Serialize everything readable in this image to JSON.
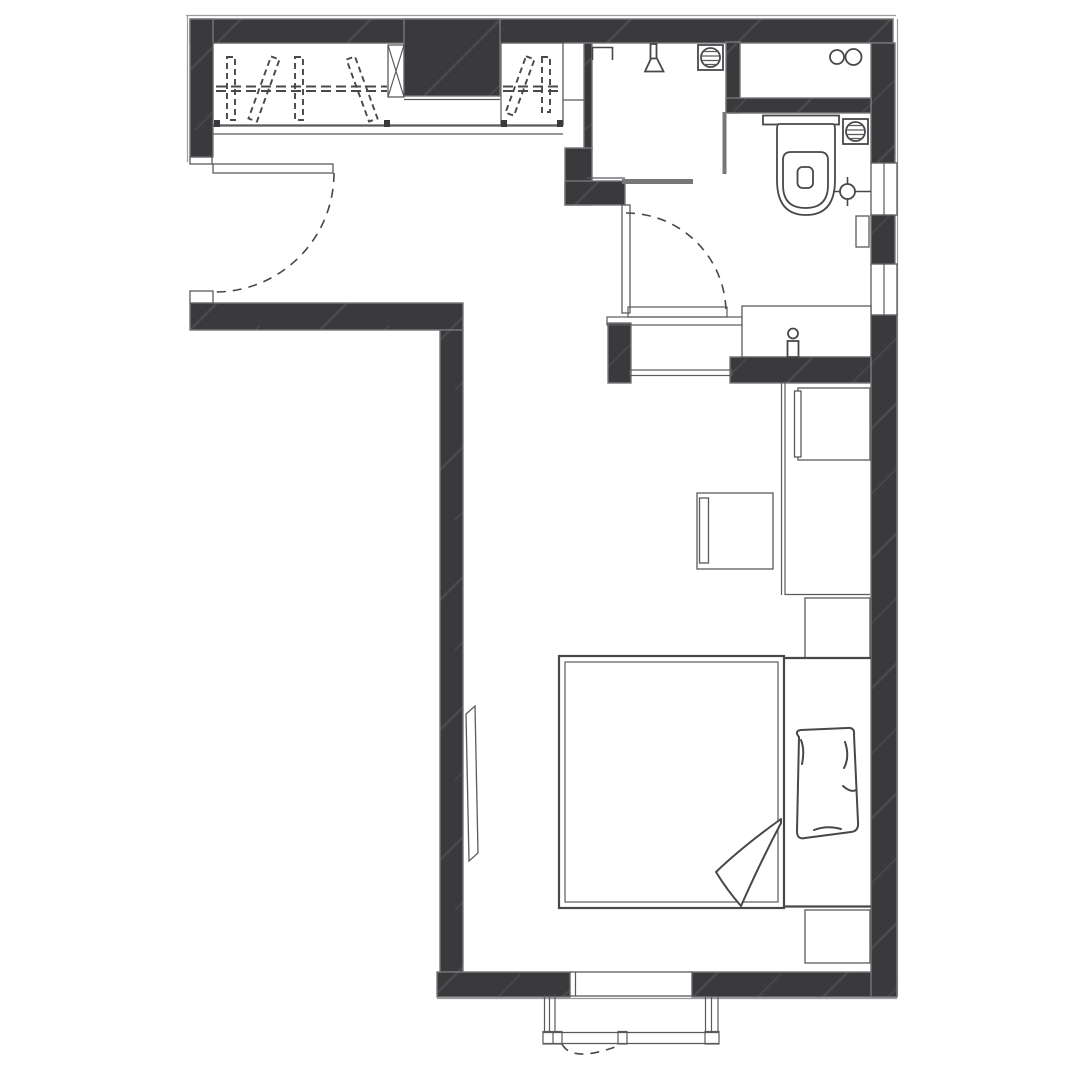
{
  "document": {
    "kind": "apartment-floor-plan-drawing",
    "visible_text": []
  },
  "colors": {
    "background": "#ffffff",
    "wall_fill": "#3a3a3c",
    "wall_hatch": "#4b4b4e",
    "wall_edge": "#77777a",
    "line_dark": "#48484b",
    "line_mid": "#5a5a5d",
    "line_light": "#9b9b9d"
  },
  "fixtures": [
    "entry-door",
    "entry-door-swing",
    "wardrobe",
    "clothes-hangers",
    "hanging-rail",
    "shelf-column-x",
    "built-in-dark-block",
    "shower-room",
    "shower-head",
    "towel-bar",
    "floor-drain",
    "glass-partition",
    "bathroom-door",
    "bathroom-door-swing",
    "storage-niche",
    "niche-circles",
    "toilet",
    "water-supply-point",
    "wall-cabinet",
    "vanity-counter",
    "faucet",
    "bedroom-doorway-threshold",
    "desk-counter",
    "desk-cabinet",
    "chair",
    "nightstand",
    "bed",
    "duvet",
    "duvet-fold",
    "pillow",
    "bench",
    "wall-tv",
    "window",
    "balcony-railing",
    "balcony-window-swing"
  ]
}
